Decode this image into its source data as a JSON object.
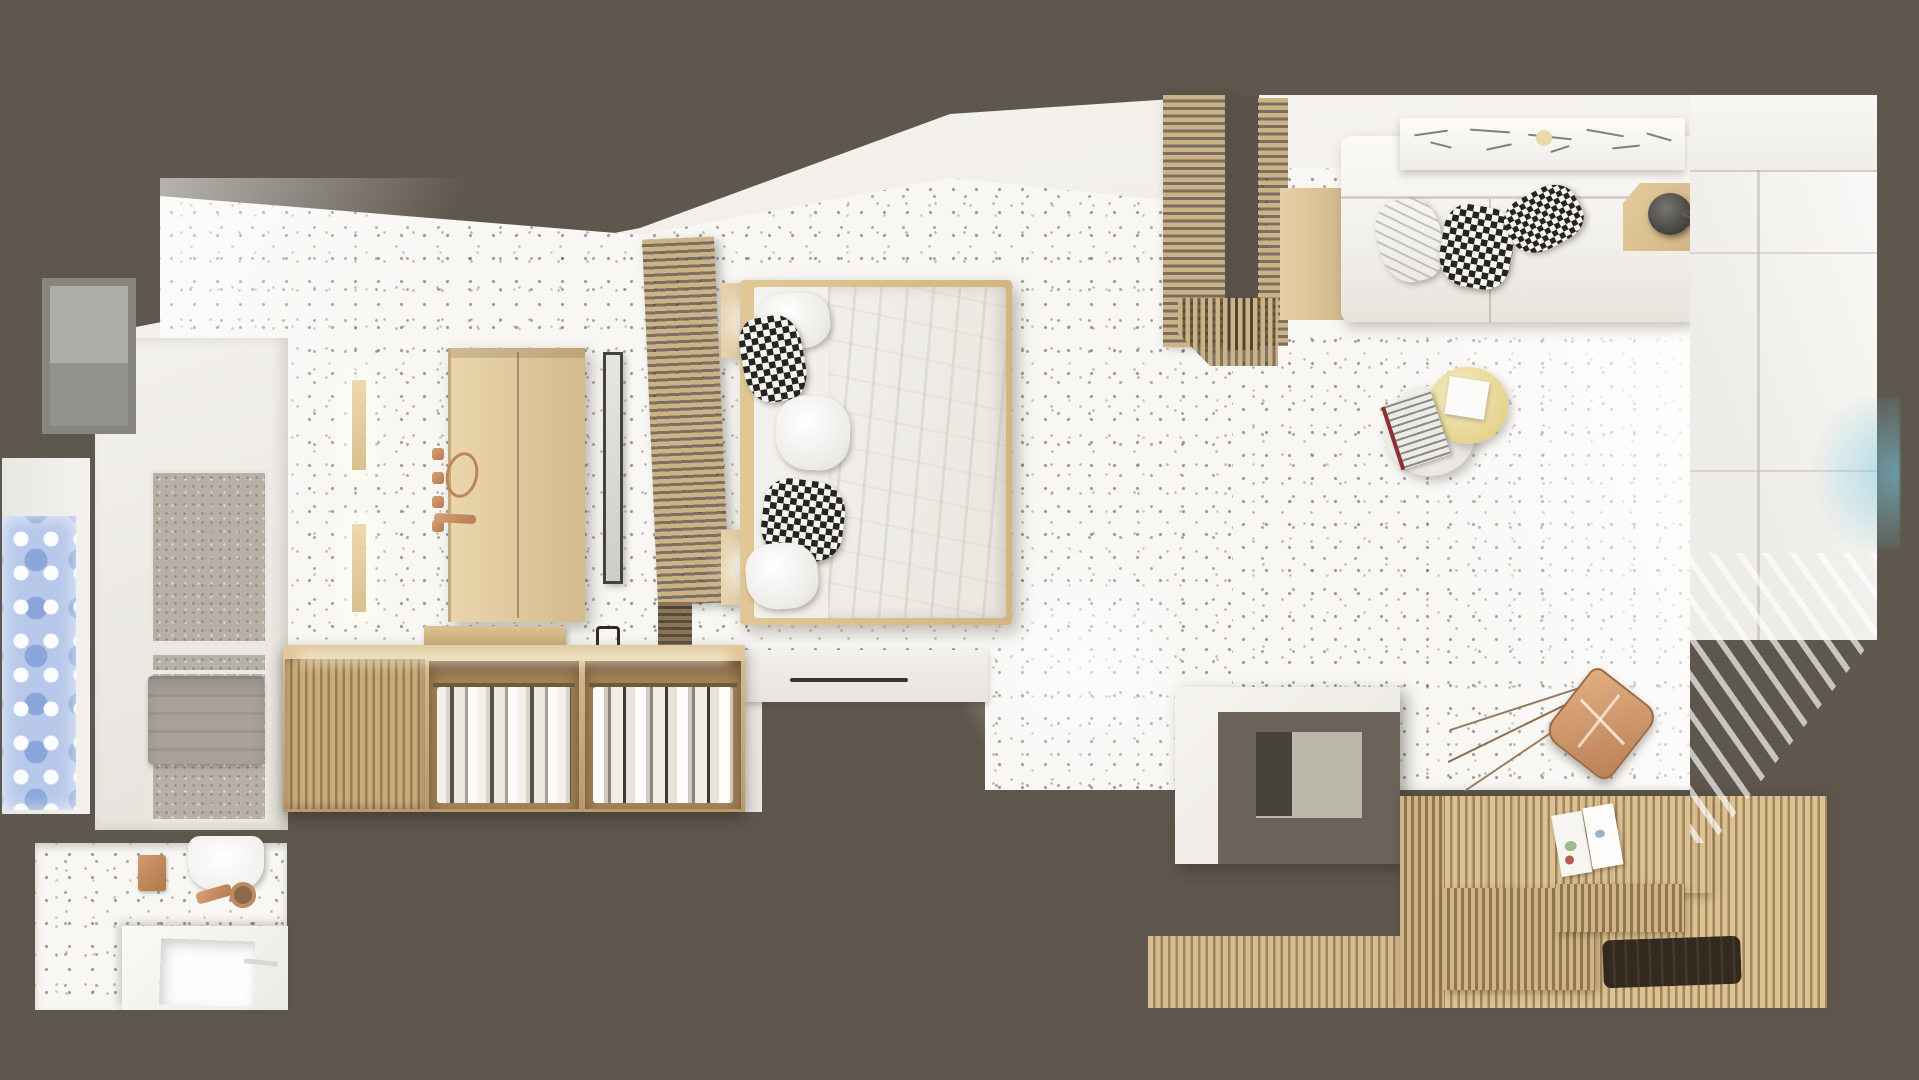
{
  "scene": {
    "title": "Top-down 3D render of a Scandinavian studio apartment",
    "style": "photorealistic bird's-eye interior rendering, no text in image",
    "rooms": [
      {
        "name": "bedroom",
        "floor": "white terrazzo with dark speckles"
      },
      {
        "name": "living-room",
        "floor": "white terrazzo with dark speckles"
      },
      {
        "name": "shower-room",
        "floor": "grey stone"
      },
      {
        "name": "bathroom",
        "floor": "white terrazzo"
      },
      {
        "name": "sauna-deck",
        "floor": "light wood slats"
      }
    ],
    "palette": {
      "wall_surround": "#5e574d",
      "plaster": "#f2f0ec",
      "terrazzo_base": "#f8f7f4",
      "terrazzo_speckle": "#6d665c",
      "wood_light": "#e0c9a0",
      "wood_slat": "#cdb285",
      "wood_deck": "#d2b586",
      "copper_accent": "#c08a63",
      "ornament_glass_blue": "#b7c8ea",
      "flare_blue": "#7fc3db",
      "mat_dark": "#33291e"
    },
    "labels": {
      "backdrop": "Dark taupe wall surround",
      "bedroom_block": "Bedroom volume with white plaster walls",
      "bedroom_floor": "Terrazzo bedroom floor",
      "living_base": "Living room volume",
      "living_floor": "Terrazzo living room floor",
      "sunlight": "Diagonal sunlight patch",
      "bed": "Double bed with light wood frame",
      "mattress": "White mattress",
      "duvet": "Crumpled white duvet",
      "pillow_patterned": "Black and white patterned pillow",
      "pillow_white": "White pillow",
      "headboard": "Wooden slatted headboard partition",
      "headboard_tail": "Shaded end of slatted partition",
      "partition": "Wooden slatted room divider",
      "partition_corner": "Slatted divider corner return",
      "door_gap": "Open doorway between bedroom and living room",
      "nightstand": "Floating wooden nightstand",
      "ball_lamp": "Glowing sphere table lamp",
      "wardrobe": "Light oak two-door wardrobe",
      "hook": "Copper wall hook",
      "strap": "Hanging copper strap",
      "rail": "Copper accessory rail",
      "mirror": "Freestanding slim dressing mirror",
      "wall_light": "Wooden wall light strip",
      "step": "White platform step with sliding door track",
      "track": "Recessed door track",
      "closet": "Open wardrobe unit with hanging clothes",
      "closet_door": "Slatted sliding wardrobe door",
      "clothes": "Row of hanging clothes",
      "wall_cabinet": "Wall-hung wooden cabinet",
      "towel_ring": "Black towel ring",
      "shower_room": "Shower room volume",
      "shower_floor": "Walk-in shower stone floor",
      "towel": "Grey towel on rail",
      "towel_rail": "Towel rail",
      "niche": "Recessed grey wall niche",
      "deco_window": "Ornamental blue patterned glass panel",
      "bathroom_floor": "Bathroom terrazzo floor",
      "toilet": "Wall-hung white toilet",
      "flush": "Copper flush fitting",
      "drain": "Copper floor drain",
      "basin_counter": "White washbasin counter",
      "basin": "Recessed square washbasin",
      "faucet": "Basin faucet",
      "bath_mirror": "Copper framed mirror",
      "sofa": "White L-shaped sofa",
      "sofa_seam": "Sofa seat seam",
      "sofa_glow": "LED glow strip under sofa",
      "sofa_wood": "Wooden sofa side platform",
      "art_shelf": "Picture ledge with pencil sketches",
      "art_accent": "Ochre accent on sketch",
      "side_table": "Wooden corner side table",
      "vase": "Dark round vase",
      "branch": "Dry decorative branch",
      "coffee_table_white": "Round white coffee table",
      "coffee_table_yellow": "Round pale-yellow coffee table",
      "magazine": "Magazine on table",
      "paper": "Paper sheet on table",
      "chair": "Copper-leather butterfly chair seen from above",
      "chair_leg": "Thin copper chair frame leg",
      "column": "Service column block",
      "column_face": "Taupe top face of column",
      "column_niche": "Recessed niche in column",
      "column_slot": "Dark slot in column niche",
      "deck": "Wooden sauna deck floor",
      "deck_backrest": "Smooth wooden deck backrest panel",
      "bench_step": "Slatted wooden bench step",
      "bench_strip": "Low slatted bench strip",
      "deck_mat": "Dark slatted bath mat",
      "deck_magazine": "Open magazine on deck",
      "window_band": "Window wall with bright daylight",
      "window_sill": "Window sill band",
      "mullion": "Window mullion",
      "curtain": "Sheer curtain wedge",
      "light_flare": "Blue lens flare on glazing",
      "closet_glow": "Warm LED glow in closet",
      "bed_glow": "LED glow under bed"
    }
  }
}
